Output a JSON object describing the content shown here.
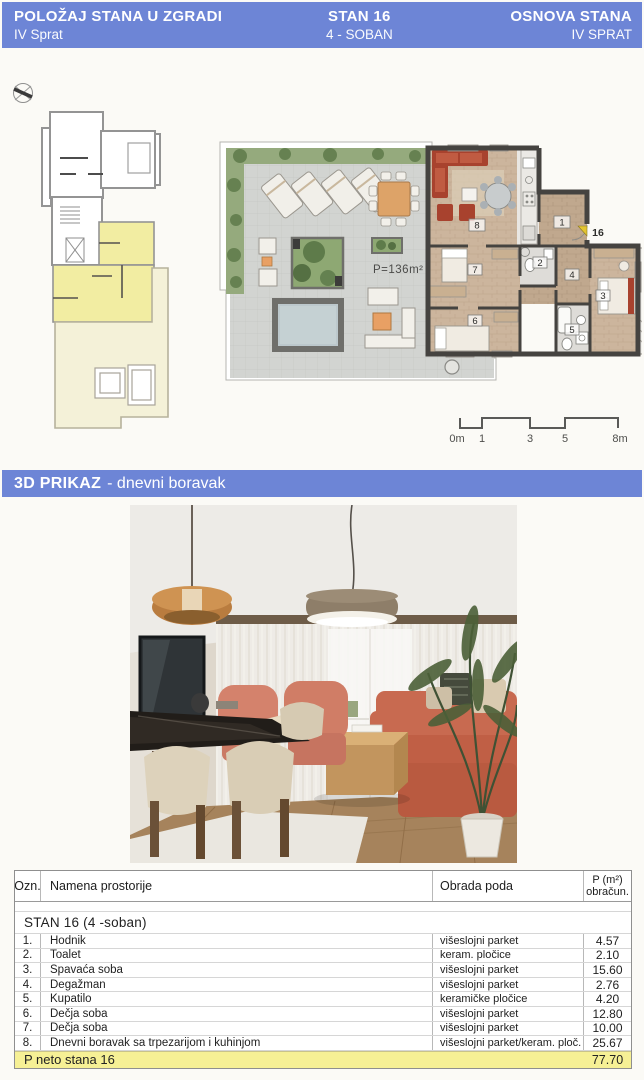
{
  "header": {
    "left_title": "POLOŽAJ STANA U ZGRADI",
    "left_subtitle": "IV Sprat",
    "center_title": "STAN 16",
    "center_subtitle": "4 - SOBAN",
    "right_title": "OSNOVA STANA",
    "right_subtitle": "IV SPRAT"
  },
  "floor_plan": {
    "area_label": "P=136m²",
    "unit_number": "16",
    "room_numbers": [
      "1",
      "2",
      "3",
      "4",
      "5",
      "6",
      "7",
      "8"
    ],
    "scale_labels": [
      "0m",
      "1",
      "3",
      "5",
      "8m"
    ]
  },
  "section_3d": {
    "title": "3D PRIKAZ",
    "subtitle": "- dnevni boravak"
  },
  "table": {
    "col_ozn": "Ozn.",
    "col_name": "Namena prostorije",
    "col_floor": "Obrada poda",
    "col_area_line1": "P (m²)",
    "col_area_line2": "obračun.",
    "section_title": "STAN 16   (4 -soban)",
    "rows": [
      {
        "num": "1.",
        "name": "Hodnik",
        "floor": "višeslojni parket",
        "area": "4.57"
      },
      {
        "num": "2.",
        "name": "Toalet",
        "floor": "keram. pločice",
        "area": "2.10"
      },
      {
        "num": "3.",
        "name": "Spavaća soba",
        "floor": "višeslojni parket",
        "area": "15.60"
      },
      {
        "num": "4.",
        "name": "Degažman",
        "floor": "višeslojni parket",
        "area": "2.76"
      },
      {
        "num": "5.",
        "name": "Kupatilo",
        "floor": "keramičke pločice",
        "area": "4.20"
      },
      {
        "num": "6.",
        "name": "Dečja soba",
        "floor": "višeslojni parket",
        "area": "12.80"
      },
      {
        "num": "7.",
        "name": "Dečja soba",
        "floor": "višeslojni parket",
        "area": "10.00"
      },
      {
        "num": "8.",
        "name": "Dnevni boravak sa trpezarijom i kuhinjom",
        "floor": "višeslojni parket/keram. ploč.",
        "area": "25.67"
      }
    ],
    "total_label": "P neto stana 16",
    "total_value": "77.70"
  },
  "colors": {
    "header_blue": "#6d85d6",
    "highlight_yellow": "#f6f095",
    "apartment_yellow": "#f2eda2",
    "terrace_pale": "#f4f1d8"
  }
}
